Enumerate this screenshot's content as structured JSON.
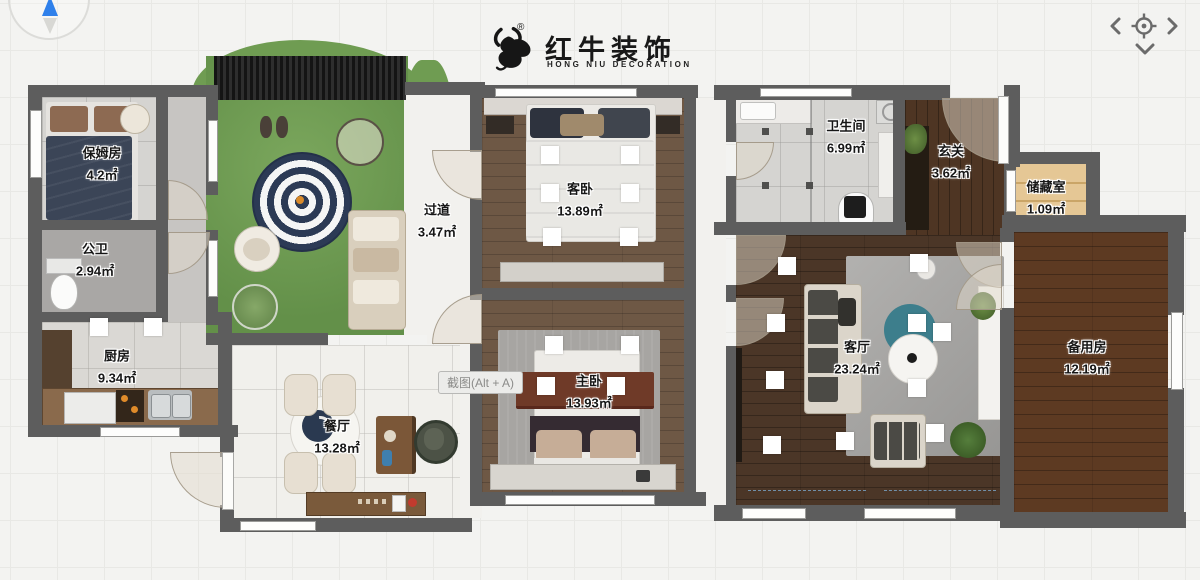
{
  "header": {
    "logo": {
      "brand_cn": "红牛装饰",
      "brand_en": "HONG NIU DECORATION",
      "registered_mark": "®"
    },
    "nav_icons": [
      "chevron-left",
      "crosshair-target",
      "chevron-right",
      "chevron-down"
    ]
  },
  "compass": {
    "icon": "north-arrow",
    "accent_color": "#2f80ea"
  },
  "tooltip": {
    "text": "截图(Alt + A)"
  },
  "rooms": [
    {
      "id": "baomufang",
      "name": "保姆房",
      "area": "4.2㎡"
    },
    {
      "id": "gongwei",
      "name": "公卫",
      "area": "2.94㎡"
    },
    {
      "id": "chufang",
      "name": "厨房",
      "area": "9.34㎡"
    },
    {
      "id": "guodao",
      "name": "过道",
      "area": "3.47㎡"
    },
    {
      "id": "kewo",
      "name": "客卧",
      "area": "13.89㎡"
    },
    {
      "id": "zhuwo",
      "name": "主卧",
      "area": "13.93㎡"
    },
    {
      "id": "canting",
      "name": "餐厅",
      "area": "13.28㎡"
    },
    {
      "id": "weishengjian",
      "name": "卫生间",
      "area": "6.99㎡"
    },
    {
      "id": "xuanguan",
      "name": "玄关",
      "area": "3.62㎡"
    },
    {
      "id": "chucangshi",
      "name": "储藏室",
      "area": "1.09㎡"
    },
    {
      "id": "keting",
      "name": "客厅",
      "area": "23.24㎡"
    },
    {
      "id": "beiyongfang",
      "name": "备用房",
      "area": "12.19㎡"
    }
  ],
  "colors": {
    "wall": "#5d5d5d",
    "grass": "#6f9c52",
    "accent_blue": "#2f80ea",
    "background": "#f3f3f1"
  }
}
